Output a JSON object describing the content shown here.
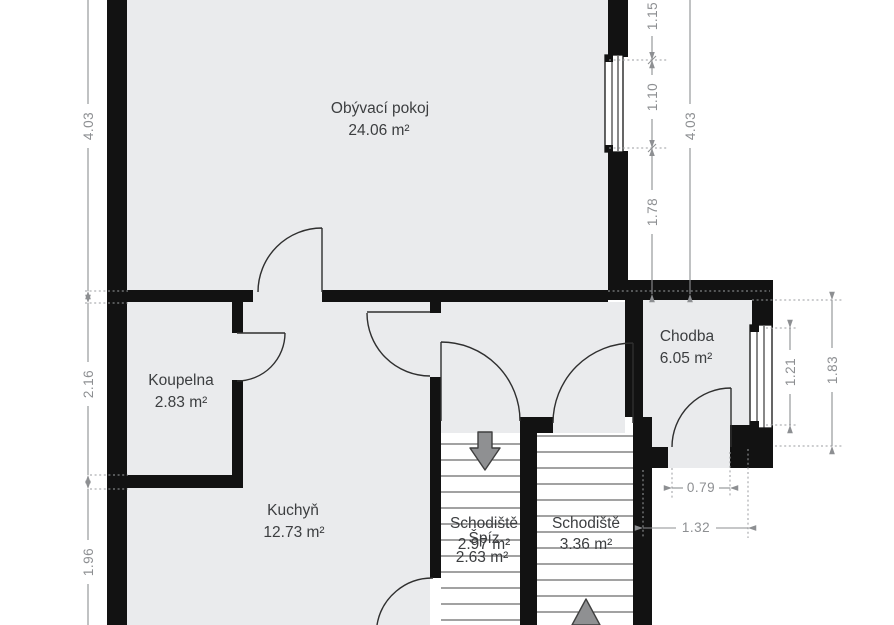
{
  "plan_title": "Floor plan",
  "rooms": {
    "living_room": {
      "name": "Obývací pokoj",
      "area": "24.06 m²"
    },
    "bathroom": {
      "name": "Koupelna",
      "area": "2.83 m²"
    },
    "kitchen": {
      "name": "Kuchyň",
      "area": "12.73 m²"
    },
    "hallway": {
      "name": "Chodba",
      "area": "6.05 m²"
    },
    "stair_left": {
      "name": "Schodiště",
      "area": "2.97 m²"
    },
    "pantry": {
      "name": "Špíz",
      "area": "2.63 m²"
    },
    "stair_right": {
      "name": "Schodiště",
      "area": "3.36 m²"
    }
  },
  "dimensions": {
    "left_living_height": "4.03",
    "left_bathroom_height": "2.16",
    "left_kitchen_height": "1.96",
    "right_above_window": "1.15",
    "right_window": "1.10",
    "right_below_window": "1.78",
    "right_living_total": "4.03",
    "hall_window": "1.21",
    "hall_side_total": "1.83",
    "entry_door_width": "0.79",
    "entry_total_width": "1.32"
  },
  "colors": {
    "wall": "#121212",
    "floor": "#eaebed",
    "dimension": "#8d8f92",
    "label": "#3c3e40",
    "stair_arrow": "#8f9092"
  }
}
